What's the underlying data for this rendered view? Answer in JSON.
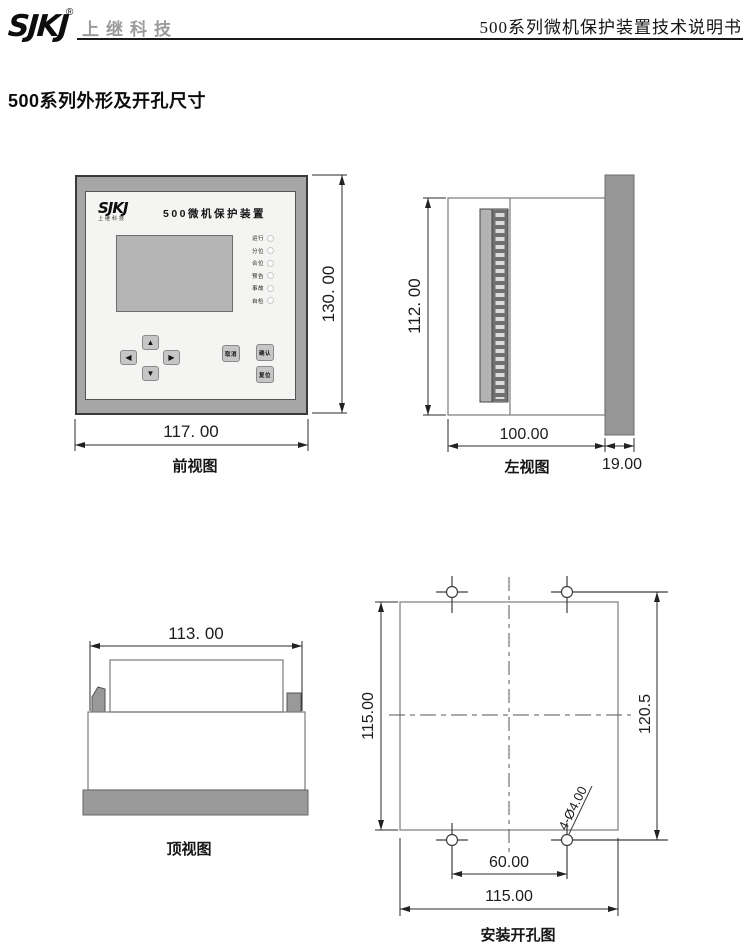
{
  "header": {
    "logo_text": "SJKJ",
    "registered_mark": "®",
    "company_name": "上继科技",
    "doc_title": "500系列微机保护装置技术说明书"
  },
  "section_title": "500系列外形及开孔尺寸",
  "front_view": {
    "caption": "前视图",
    "device": {
      "logo": "SJKJ",
      "logo_sub": "上继科技",
      "panel_title": "500微机保护装置",
      "leds": [
        "运行",
        "分位",
        "合位",
        "预告",
        "事故",
        "自检"
      ],
      "keys": {
        "up": "▲",
        "left": "◀",
        "right": "▶",
        "down": "▼"
      },
      "buttons": [
        "取消",
        "确认",
        "复位"
      ]
    },
    "dims": {
      "width": "117. 00",
      "height": "130. 00"
    }
  },
  "left_view": {
    "caption": "左视图",
    "dims": {
      "height": "112. 00",
      "depth": "100.00",
      "bezel": "19.00"
    }
  },
  "top_view": {
    "caption": "顶视图",
    "dims": {
      "width": "113. 00"
    }
  },
  "install_view": {
    "caption": "安装开孔图",
    "dims": {
      "cutout_height": "115.00",
      "hole_spacing_v": "120.5",
      "hole_spacing_h": "60.00",
      "cutout_width": "115.00",
      "hole_note": "4-Ø4.00"
    }
  },
  "colors": {
    "frame_gray": "#a6a6a6",
    "panel_face": "#f4f4f2",
    "lcd_gray": "#b5b5b5",
    "fill_gray": "#999999",
    "line_dark": "#2a2a2a"
  }
}
